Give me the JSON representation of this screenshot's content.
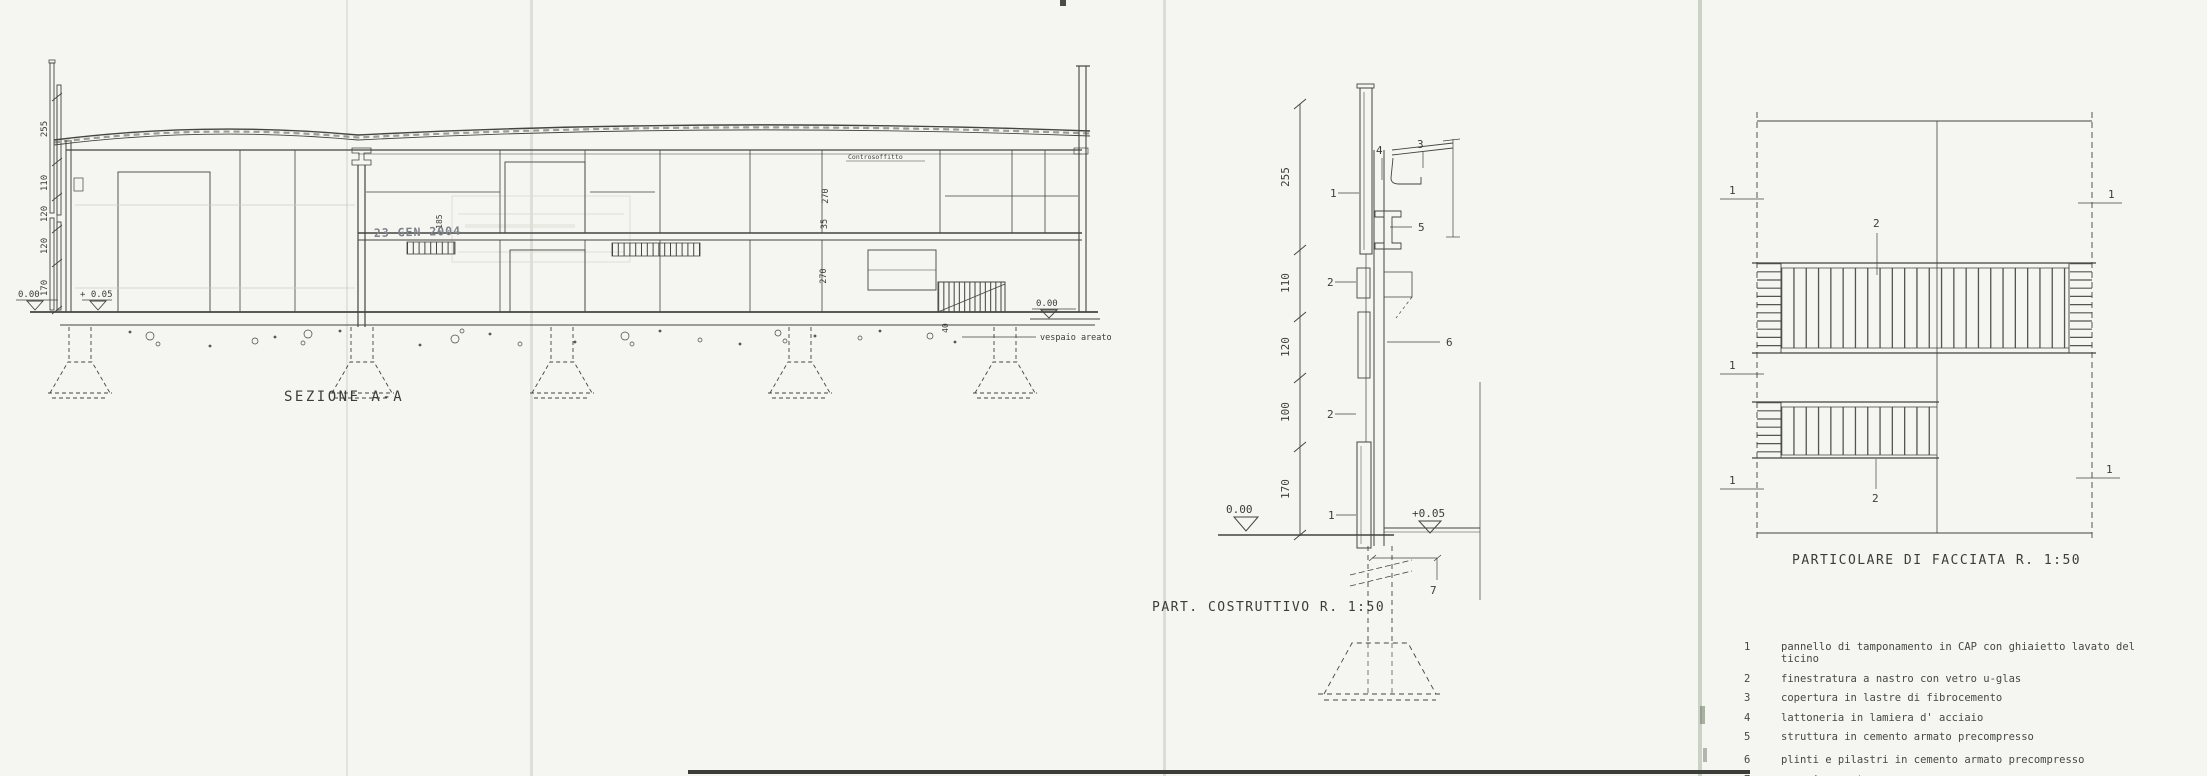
{
  "sheet": {
    "paper": "#f5f5f1",
    "ink": "#45453f"
  },
  "section": {
    "title": "SEZIONE A-A",
    "stamp_date": "23 GEN 2004",
    "stamp_level": "+185",
    "dim_chain": [
      "255",
      "110",
      "120",
      "120",
      "170"
    ],
    "interior_dims": {
      "upper_room": "270",
      "slab": "35",
      "lower_room": "270",
      "stair": "40"
    },
    "levels": {
      "ground_left": "0.00",
      "floor_left": "+ 0.05",
      "ground_right": "0.00"
    },
    "notes": {
      "ceiling": "Controsoffitto",
      "crawl_space": "vespaio areato"
    }
  },
  "construction_detail": {
    "title": "PART. COSTRUTTIVO R. 1:50",
    "dim_chain": [
      "255",
      "110",
      "120",
      "100",
      "170"
    ],
    "levels": {
      "ground": "0.00",
      "floor": "+0.05"
    },
    "callouts": {
      "c1": "1",
      "c2": "2",
      "c3": "3",
      "c4": "4",
      "c5": "5",
      "c6": "6",
      "c7": "7"
    }
  },
  "facade_detail": {
    "title": "PARTICOLARE DI FACCIATA R. 1:50",
    "callouts": {
      "panel": "1",
      "window": "2"
    }
  },
  "legend": {
    "items": [
      {
        "num": "1",
        "text": "pannello di tamponamento in CAP con ghiaietto lavato del ticino"
      },
      {
        "num": "2",
        "text": "finestratura a nastro con vetro u-glas"
      },
      {
        "num": "3",
        "text": "copertura in lastre di fibrocemento"
      },
      {
        "num": "4",
        "text": "lattoneria in lamiera d' acciaio"
      },
      {
        "num": "5",
        "text": "struttura in cemento armato precompresso"
      },
      {
        "num": "6",
        "text": "plinti e pilastri in cemento armato precompresso"
      },
      {
        "num": "7",
        "text": "vespaio areato"
      }
    ]
  }
}
